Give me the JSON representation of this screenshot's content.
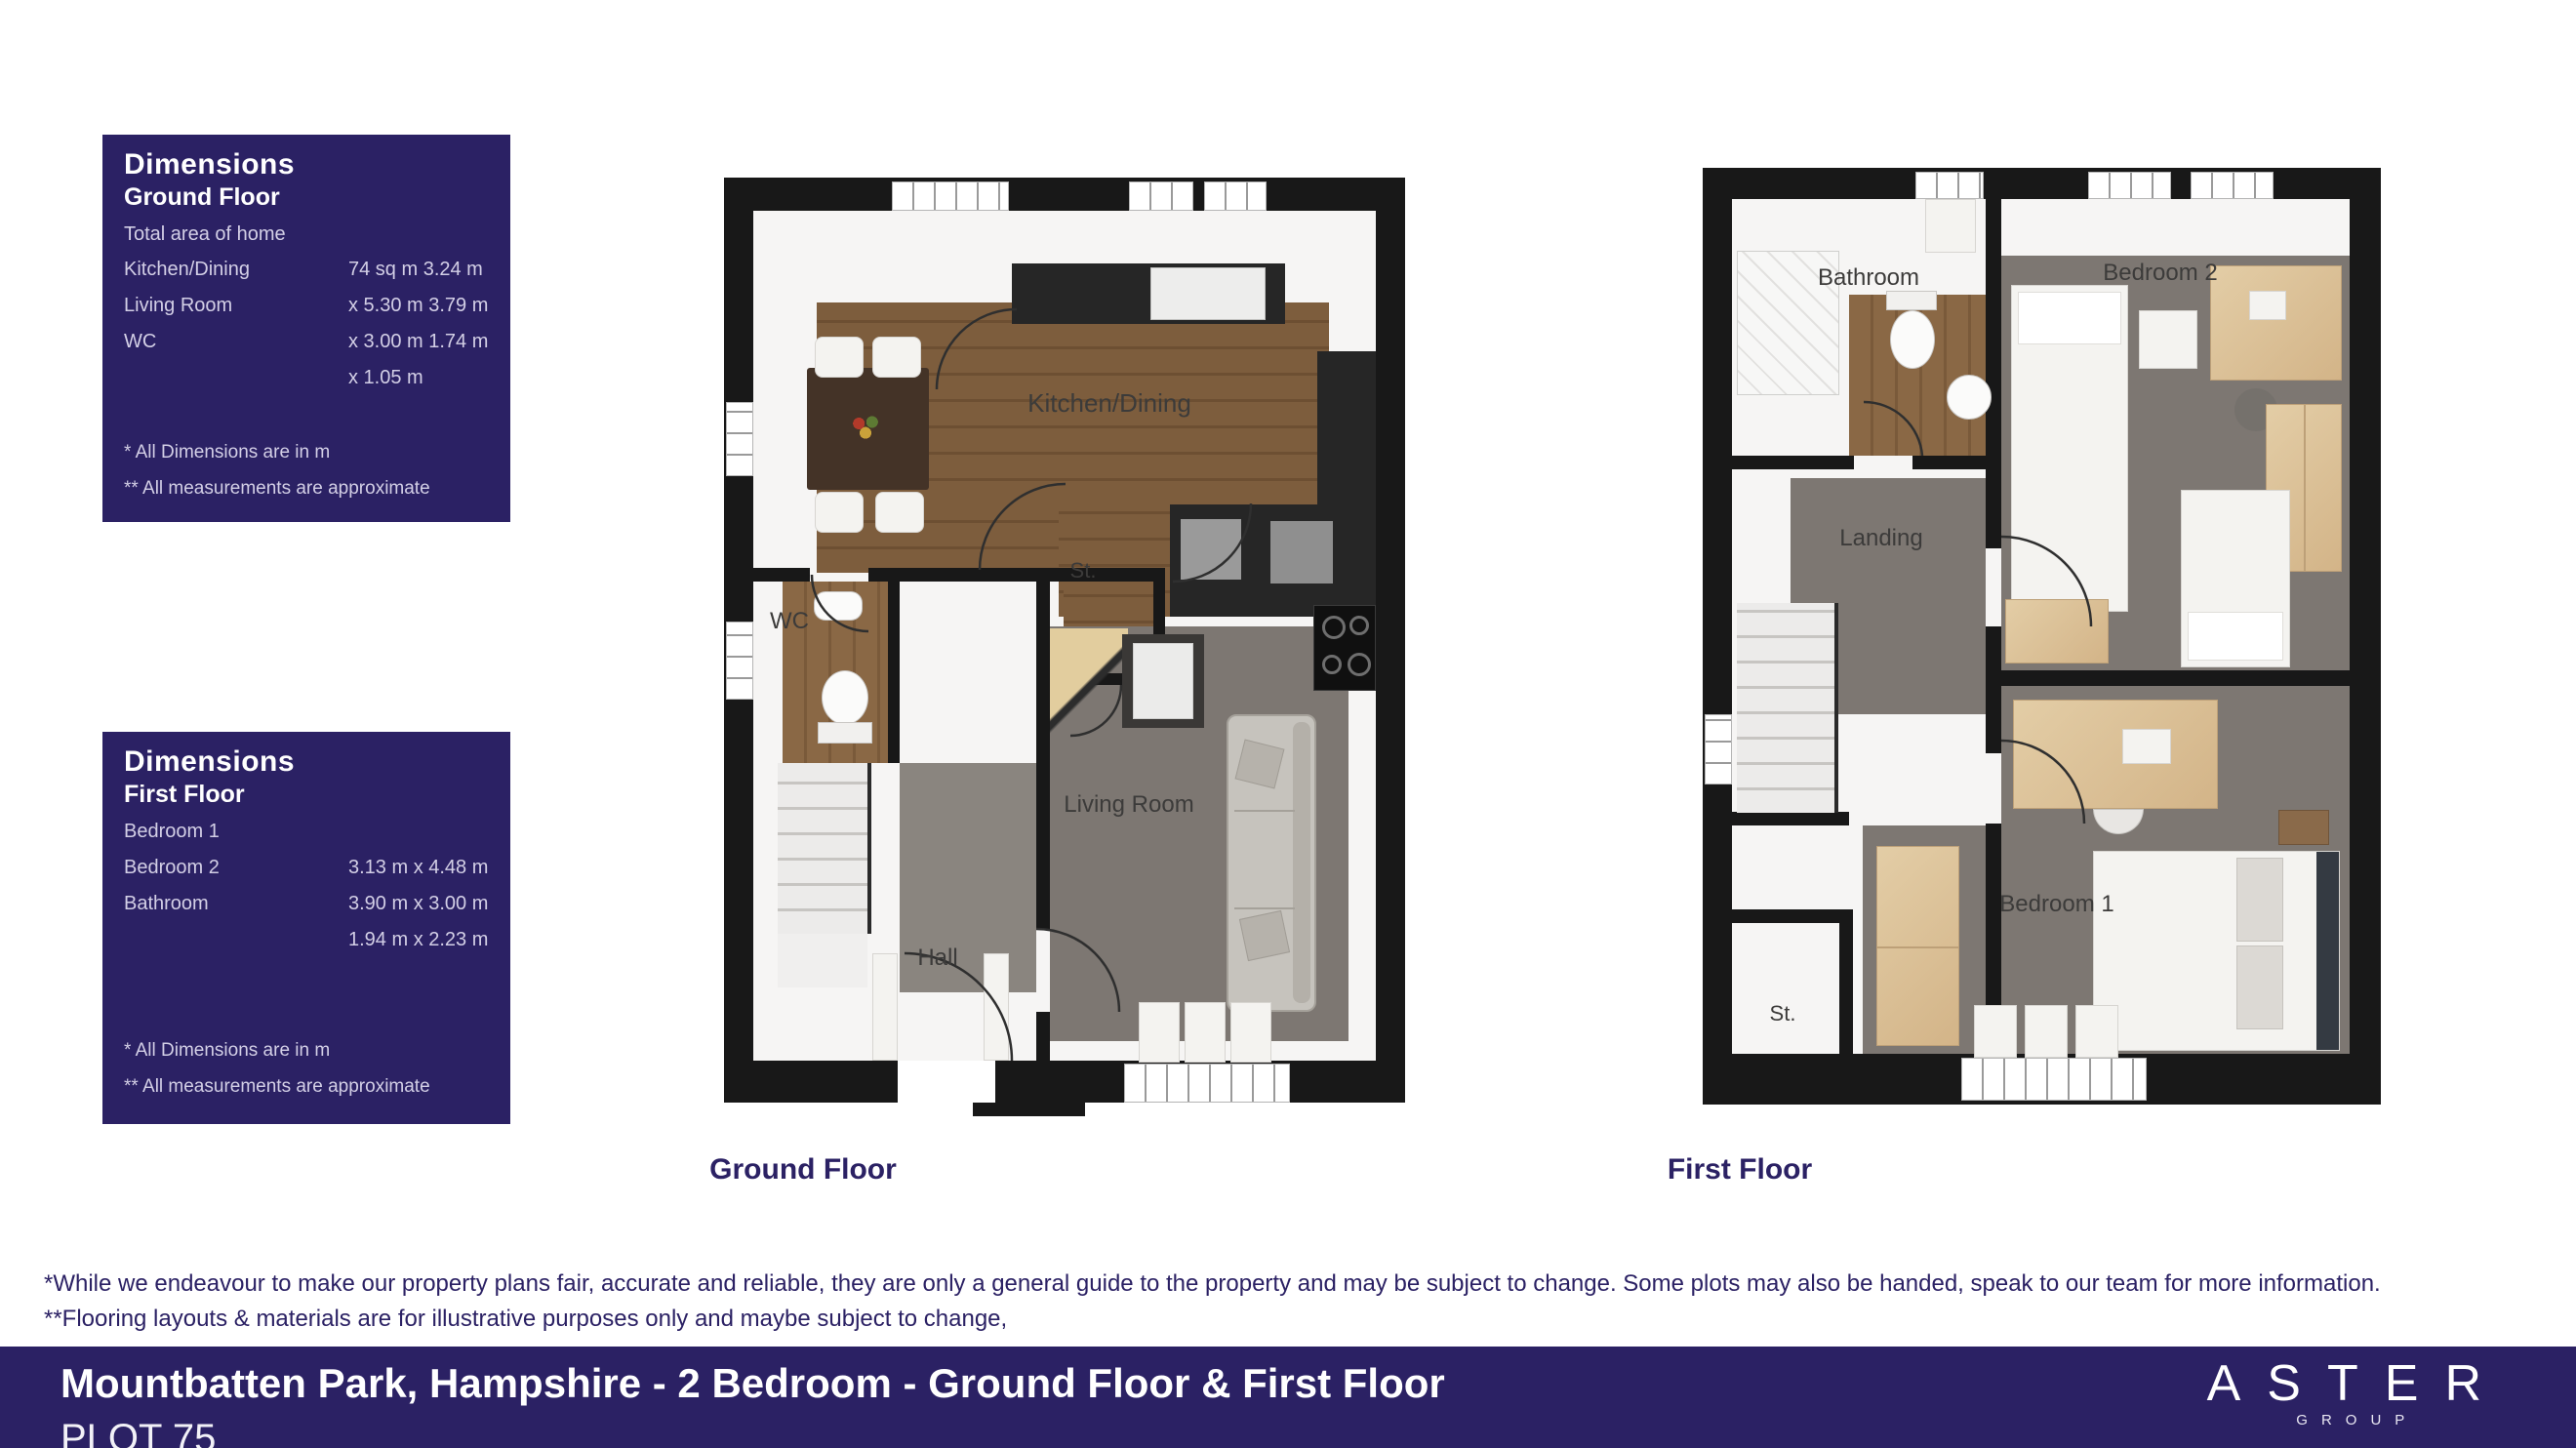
{
  "dimensions_ground": {
    "title": "Dimensions",
    "subtitle": "Ground Floor",
    "rows": [
      {
        "label": "Total area of home",
        "value": ""
      },
      {
        "label": "Kitchen/Dining",
        "value": "74 sq m 3.24 m"
      },
      {
        "label": "Living Room",
        "value": "x 5.30 m 3.79 m"
      },
      {
        "label": "WC",
        "value": "x 3.00 m 1.74 m"
      },
      {
        "label": "",
        "value": "x 1.05 m"
      }
    ],
    "footnote1": "* All Dimensions are in m",
    "footnote2": "** All measurements are approximate"
  },
  "dimensions_first": {
    "title": "Dimensions",
    "subtitle": "First Floor",
    "rows": [
      {
        "label": "Bedroom 1",
        "value": ""
      },
      {
        "label": "Bedroom 2",
        "value": "3.13 m x 4.48 m"
      },
      {
        "label": "Bathroom",
        "value": "3.90 m x 3.00 m"
      },
      {
        "label": "",
        "value": "1.94 m x 2.23 m"
      }
    ],
    "footnote1": "* All Dimensions are in m",
    "footnote2": "** All measurements are approximate"
  },
  "ground_plan": {
    "caption": "Ground Floor",
    "rooms": {
      "kitchen_dining": "Kitchen/Dining",
      "wc": "WC",
      "storage": "St.",
      "hall": "Hall",
      "living_room": "Living Room"
    }
  },
  "first_plan": {
    "caption": "First Floor",
    "rooms": {
      "bathroom": "Bathroom",
      "bedroom2": "Bedroom 2",
      "landing": "Landing",
      "storage": "St.",
      "bedroom1": "Bedroom 1"
    }
  },
  "disclaimer": {
    "line1": "*While we endeavour to make our property plans fair, accurate and reliable, they are only a general guide to the property and may be subject to change. Some plots may also be handed, speak to our team for more information.",
    "line2": "**Flooring layouts & materials are for illustrative purposes only and maybe subject to change,"
  },
  "footer": {
    "title": "Mountbatten Park, Hampshire - 2 Bedroom - Ground Floor & First Floor",
    "plot": "PLOT 75",
    "brand": "ASTER",
    "brand_sub": "GROUP"
  },
  "colors": {
    "navy": "#2b2164",
    "wall_black": "#181818",
    "wood_floor": "#7d5d3d",
    "grey_floor": "#7d7772",
    "light_wood": "#e3cda6"
  }
}
